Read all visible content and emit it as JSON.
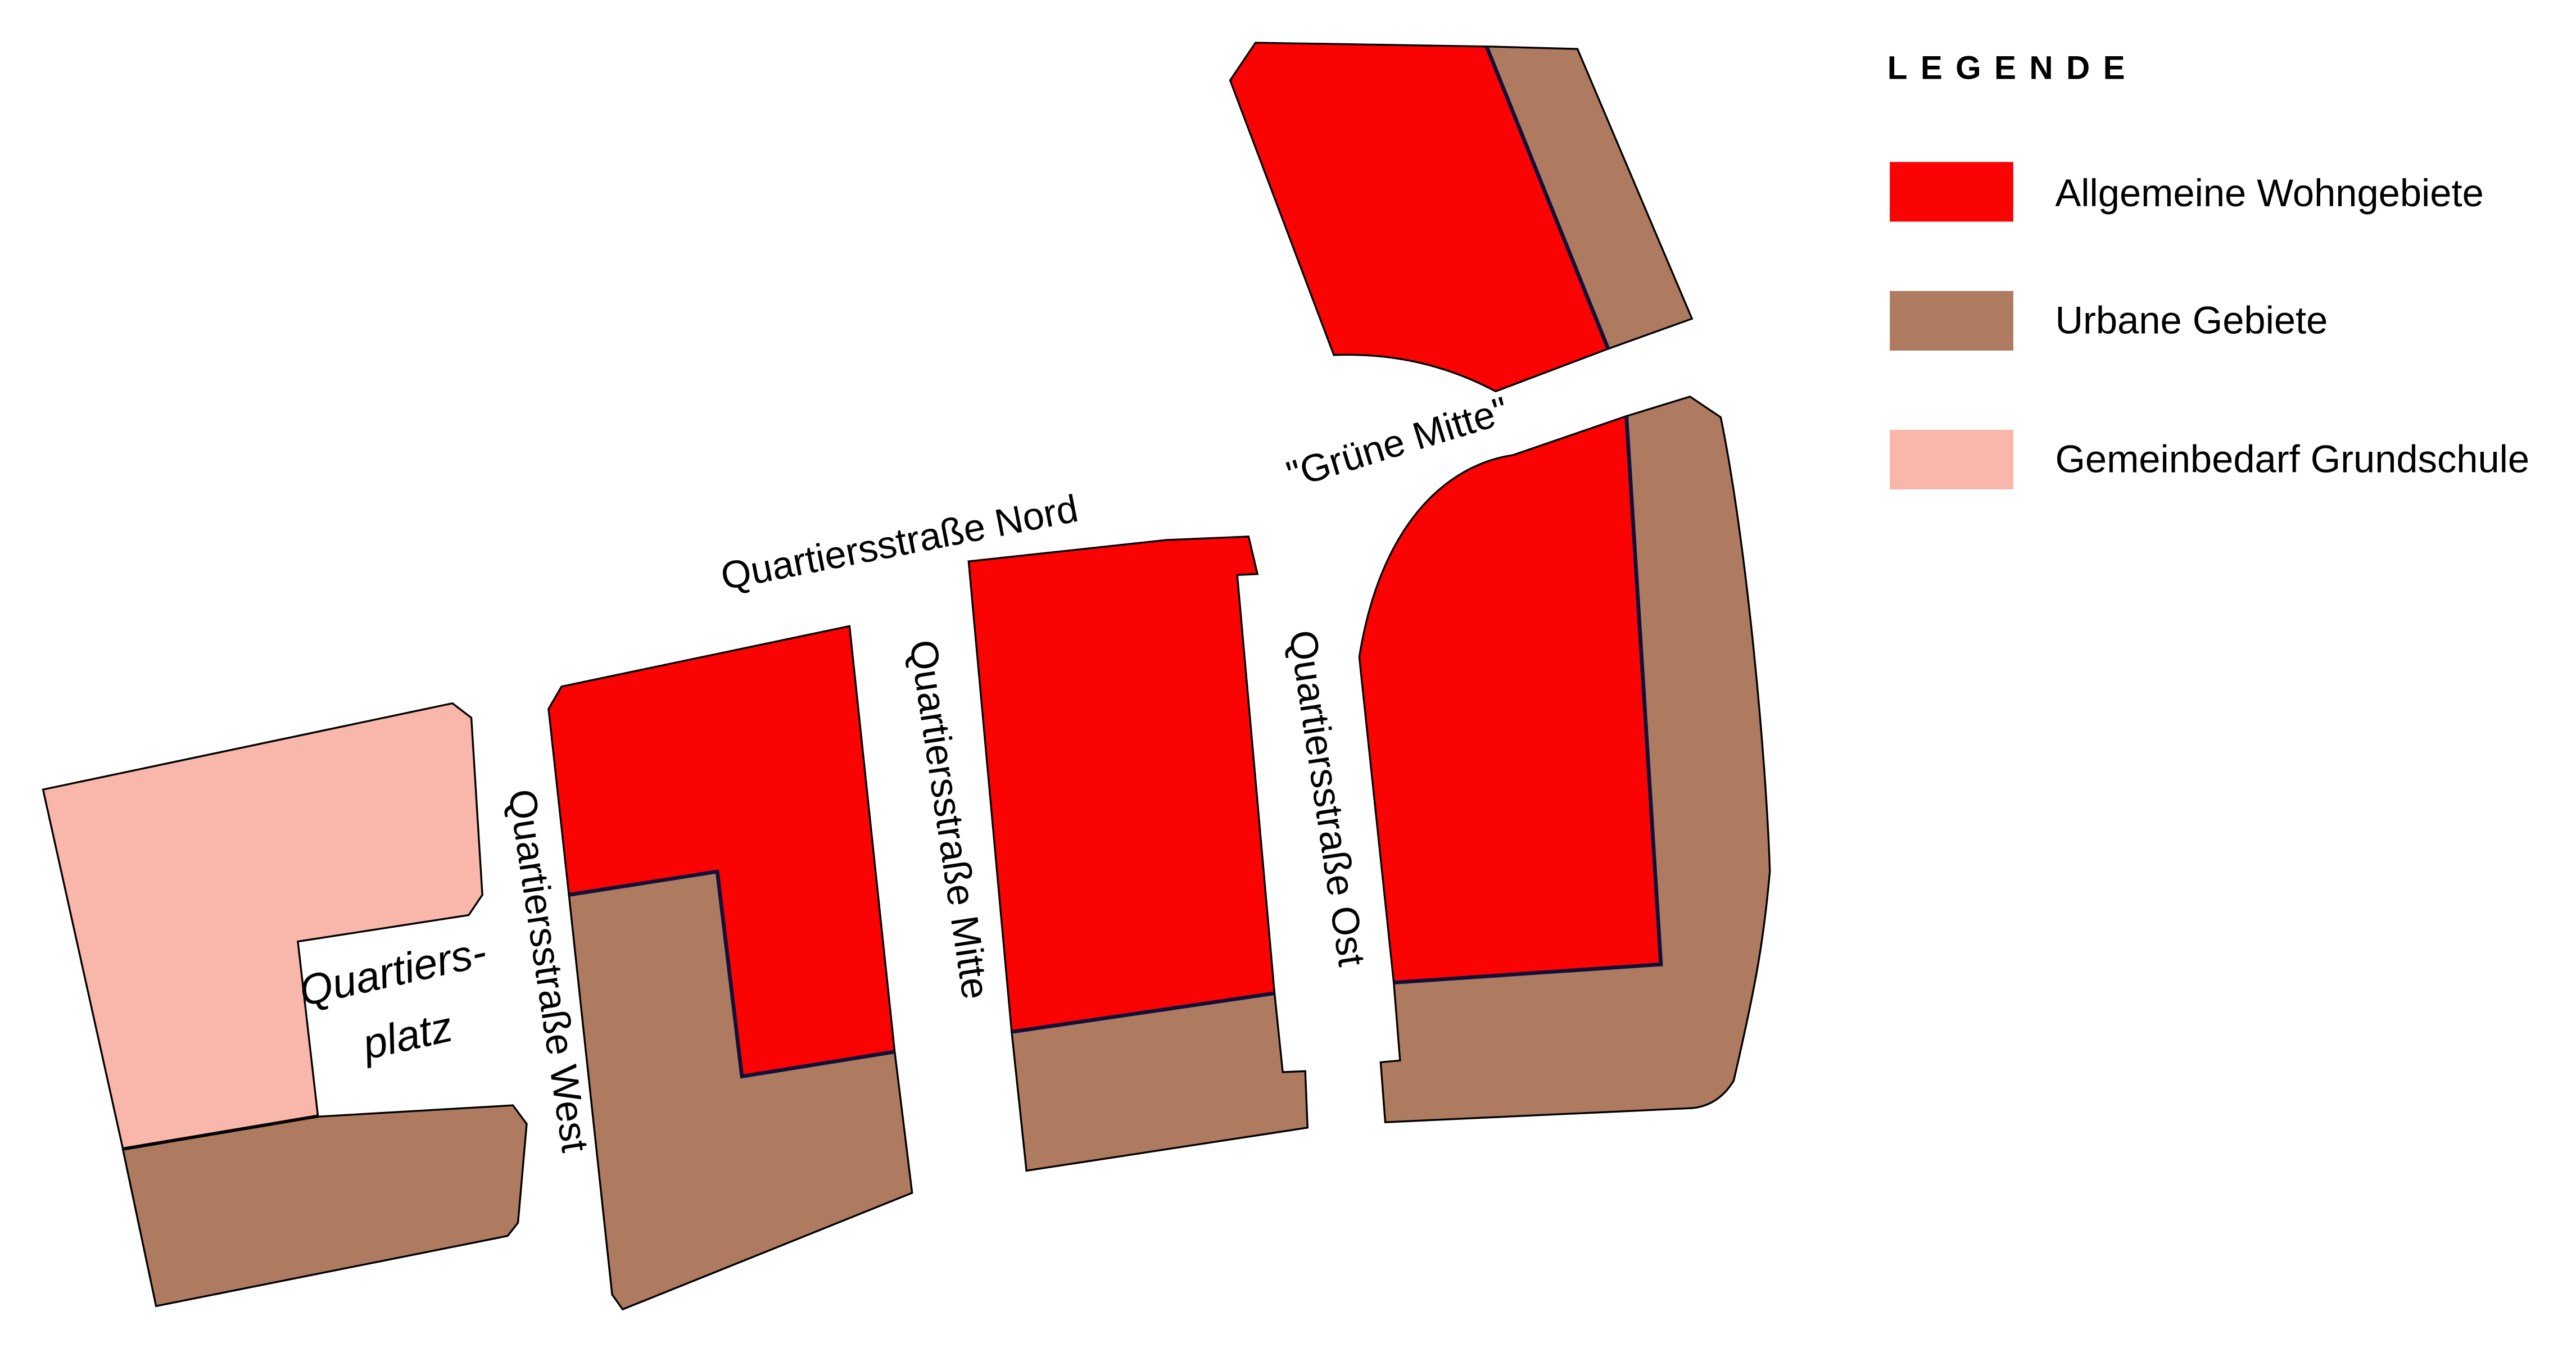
{
  "colors": {
    "residential": "#fb0302",
    "urban": "#ae7b61",
    "school": "#f9b7ab",
    "divider": "#101038",
    "outline": "#000000"
  },
  "legend": {
    "title": "LEGENDE",
    "items": [
      {
        "label": "Allgemeine Wohngebiete",
        "color_key": "residential"
      },
      {
        "label": "Urbane Gebiete",
        "color_key": "urban"
      },
      {
        "label": "Gemeinbedarf Grundschule",
        "color_key": "school"
      }
    ]
  },
  "streets": {
    "nord": "Quartiersstraße Nord",
    "west": "Quartiersstraße West",
    "mitte": "Quartiersstraße Mitte",
    "ost": "Quartiersstraße Ost",
    "gruene_mitte": "\"Grüne Mitte\"",
    "platz_line1": "Quartiers-",
    "platz_line2": "platz"
  }
}
